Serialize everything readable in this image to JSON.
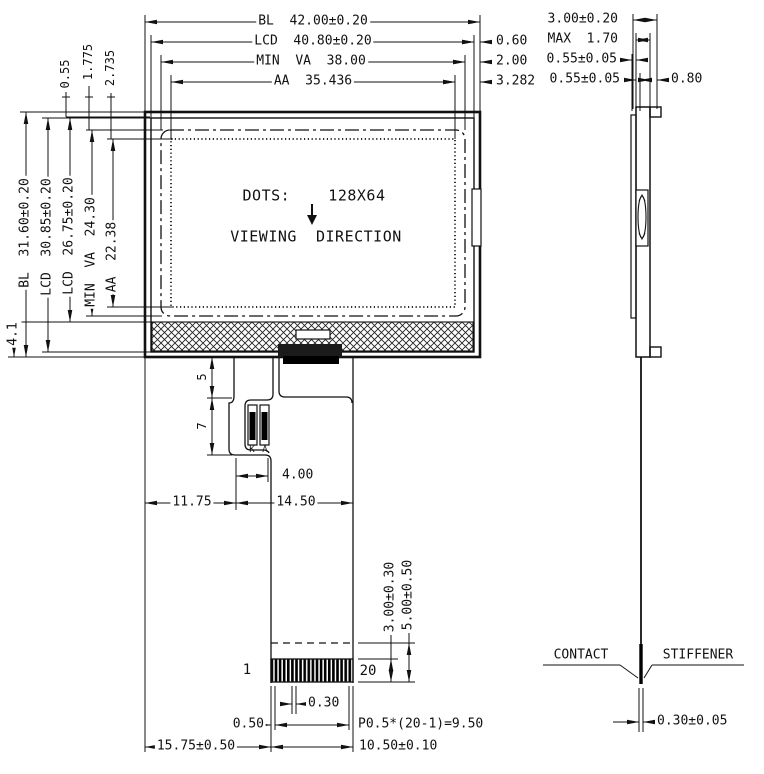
{
  "front": {
    "top": {
      "bl": "BL  42.00±0.20",
      "lcd": "LCD  40.80±0.20",
      "minva": "MIN  VA  38.00",
      "aa": "AA  35.436",
      "off_lcd": "0.60",
      "off_minva": "2.00",
      "off_aa": "3.282"
    },
    "left": {
      "bl": "BL  31.60±0.20",
      "lcd_o": "LCD  30.85±0.20",
      "lcd_i": "LCD  26.75±0.20",
      "minva": "MIN  VA  24.30",
      "aa": "AA  22.38",
      "hatch": "4.1",
      "o1": "0.55",
      "o2": "1.775",
      "o3": "2.735"
    },
    "screen": {
      "dots": "DOTS:    128X64",
      "viewing": "VIEWING  DIRECTION"
    },
    "pads": {
      "k": "K",
      "a": "A"
    },
    "tail": {
      "d5": "5",
      "d7": "7",
      "d400": "4.00",
      "d1175": "11.75",
      "d1450": "14.50",
      "pin1": "1",
      "pin20": "20",
      "d030": "0.30",
      "d050": "0.50",
      "pitch": "P0.5*(20-1)=9.50",
      "d1575": "15.75±0.50",
      "d1050": "10.50±0.10",
      "d300": "3.00±0.30",
      "d500": "5.00±0.50"
    }
  },
  "side": {
    "top": {
      "total": "3.00±0.20",
      "max": "MAX  1.70",
      "g1": "0.55±0.05",
      "g2": "0.55±0.05",
      "tab": "0.80"
    },
    "bottom": {
      "contact": "CONTACT",
      "stiffener": "STIFFENER",
      "thick": "0.30±0.05"
    }
  }
}
